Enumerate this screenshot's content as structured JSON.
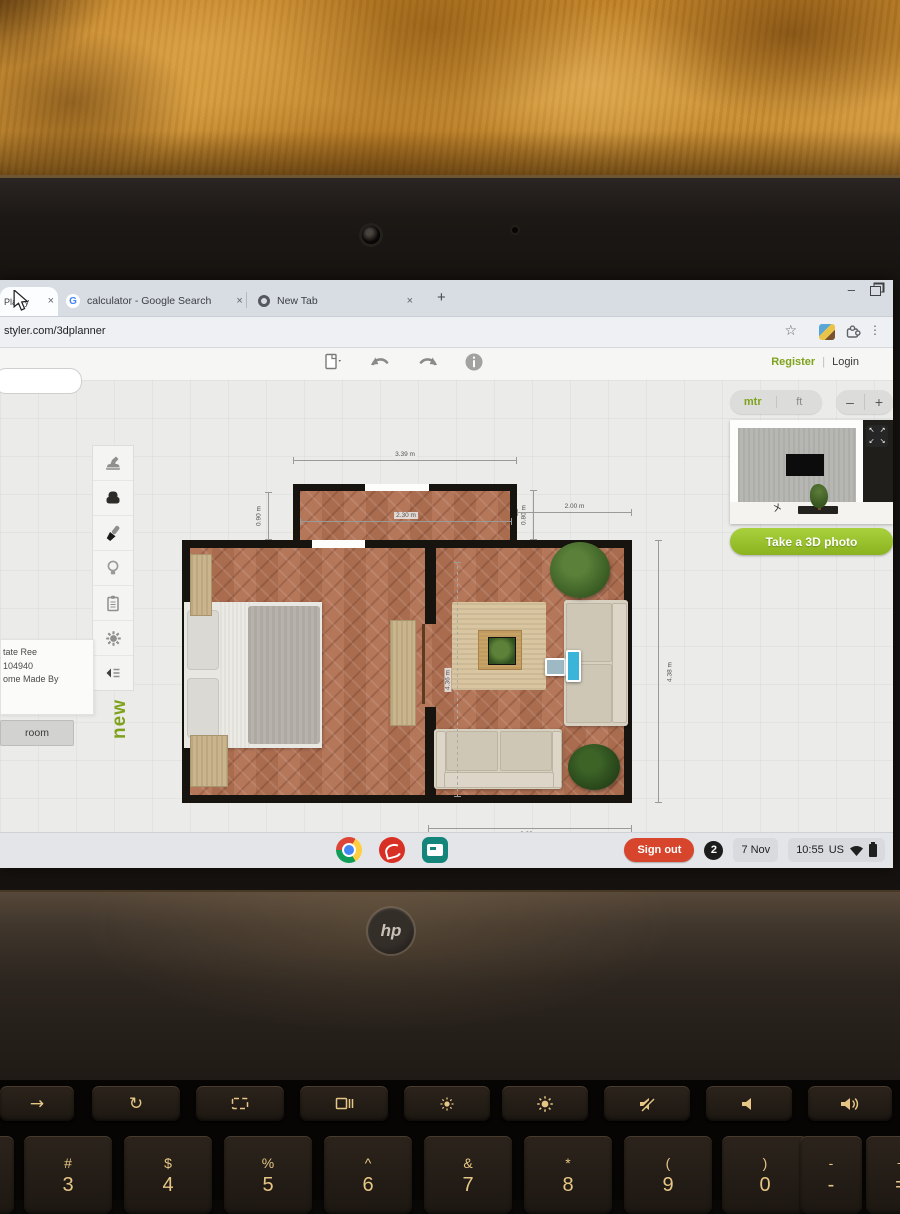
{
  "browser": {
    "glyphs": {
      "close": "×",
      "plus": "+",
      "minimize": "–",
      "star": "☆",
      "dots": "⋮"
    },
    "tab_partial_label": "Plan y",
    "tabs": [
      {
        "favicon_letter": "G",
        "label": "calculator - Google Search"
      },
      {
        "label": "New Tab"
      }
    ],
    "url": "styler.com/3dplanner"
  },
  "planner": {
    "topbar": {
      "register": "Register",
      "login": "Login"
    },
    "units": {
      "metric": "mtr",
      "imperial": "ft"
    },
    "zoom": {
      "out": "–",
      "in": "+"
    },
    "preview_button": "Take a 3D photo",
    "vertical_new": "new",
    "room_button": "room",
    "project_panel": {
      "line1": "tate Ree",
      "line2": "104940",
      "line3": "ome Made By"
    },
    "dimensions": {
      "top_width": "3.39 m",
      "top_room_width": "2.30 m",
      "left_height": "0.90 m",
      "mid_height": "0.80 m",
      "right_top_width": "2.00 m",
      "living_height": "4.36 m",
      "right_height": "4.38 m",
      "bottom_width": "3.29 m"
    },
    "expand_arrows": [
      "↖",
      "↗",
      "↙",
      "↘"
    ]
  },
  "shelf": {
    "sign_out": "Sign out",
    "notification_count": "2",
    "date": "7 Nov",
    "time": "10:55",
    "region": "US"
  },
  "laptop": {
    "logo": "hp",
    "keyboard": {
      "function_glyphs": {
        "back": "→",
        "refresh": "↻"
      },
      "number_row": [
        {
          "top": "#",
          "bottom": "3"
        },
        {
          "top": "$",
          "bottom": "4"
        },
        {
          "top": "%",
          "bottom": "5"
        },
        {
          "top": "^",
          "bottom": "6"
        },
        {
          "top": "&",
          "bottom": "7"
        },
        {
          "top": "*",
          "bottom": "8"
        },
        {
          "top": "(",
          "bottom": "9"
        },
        {
          "top": ")",
          "bottom": "0"
        },
        {
          "top": "-",
          "bottom": "-"
        },
        {
          "top": "+",
          "bottom": "="
        }
      ]
    }
  }
}
